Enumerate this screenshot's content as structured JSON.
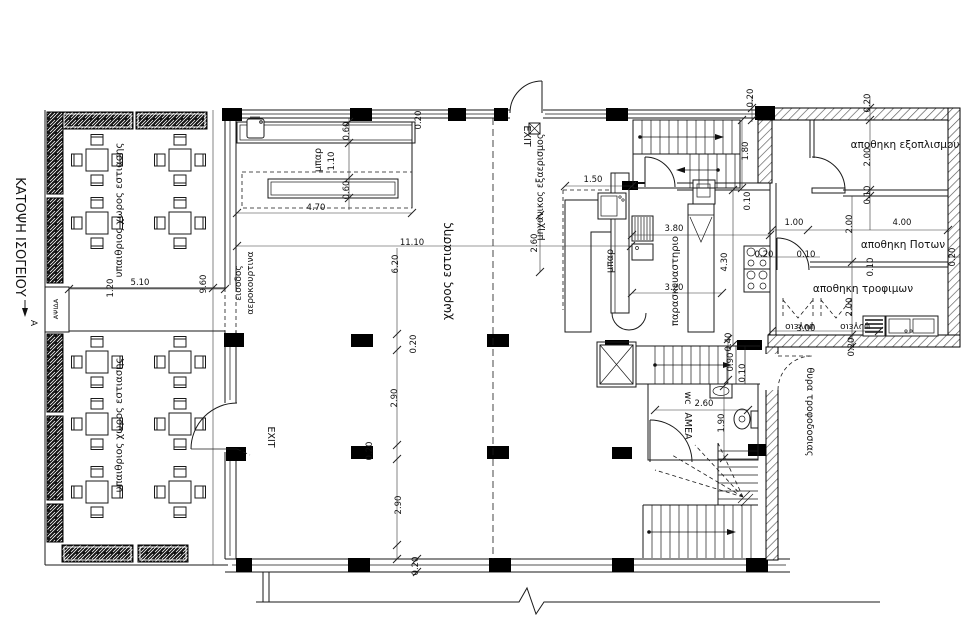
{
  "title": {
    "text": "ΚΑΤΟΨΗ ΙΣΟΓΕΙΟΥ"
  },
  "colors": {
    "line": "#1a1a1a",
    "background": "#ffffff"
  },
  "labels": [
    {
      "name": "plan-title",
      "text": "ΚΑΤΟΨΗ ΙΣΟΓΕΙΟΥ",
      "x": 16,
      "y": 237,
      "rot": 90,
      "size": 13
    },
    {
      "name": "section-marker-a",
      "text": "A",
      "x": 31,
      "y": 323,
      "rot": 90,
      "size": 9
    },
    {
      "name": "room-outdoor-dining-upper",
      "text": "υπαιθριος χωρος εστιασης",
      "x": 122,
      "y": 210,
      "rot": -90,
      "size": 10
    },
    {
      "name": "room-outdoor-dining-lower",
      "text": "υπαιθριος χωρος εστιασης",
      "x": 122,
      "y": 425,
      "rot": -90,
      "size": 10
    },
    {
      "name": "arch-label",
      "text": "ΑΨΙΔΑ",
      "x": 58,
      "y": 309,
      "rot": -90,
      "size": 6.5
    },
    {
      "name": "air-curtain-label",
      "text": "αεροκουρτινα",
      "x": 253,
      "y": 283,
      "rot": -90,
      "size": 9
    },
    {
      "name": "entrance-label",
      "text": "εισοδος",
      "x": 241,
      "y": 283,
      "rot": -90,
      "size": 9
    },
    {
      "name": "bar-label-top",
      "text": "μπαρ",
      "x": 321,
      "y": 160,
      "rot": -90,
      "size": 9.5
    },
    {
      "name": "room-dining-hall",
      "text": "χωρος εστιασης",
      "x": 451,
      "y": 271,
      "rot": -90,
      "size": 12
    },
    {
      "name": "exit-label-top",
      "text": "EXIT",
      "x": 524,
      "y": 136,
      "rot": 90,
      "size": 9.5
    },
    {
      "name": "mech-ventilation-label",
      "text": "μηχανικος εξαερισμος",
      "x": 543,
      "y": 187,
      "rot": -90,
      "size": 9.5
    },
    {
      "name": "bar-label-kitchen",
      "text": "μπαρ",
      "x": 613,
      "y": 261,
      "rot": -90,
      "size": 9.5
    },
    {
      "name": "room-kitchen",
      "text": "παρασκευαστηριο",
      "x": 678,
      "y": 281,
      "rot": -90,
      "size": 10
    },
    {
      "name": "room-storage-equipment",
      "text": "αποθηκη εξοπλισμου",
      "x": 905,
      "y": 148,
      "rot": 0,
      "size": 10.5
    },
    {
      "name": "room-storage-drinks",
      "text": "αποθηκη Ποτων",
      "x": 903,
      "y": 248,
      "rot": 0,
      "size": 10.5
    },
    {
      "name": "room-storage-food",
      "text": "αποθηκη τροφιμων",
      "x": 863,
      "y": 292,
      "rot": 0,
      "size": 10.5
    },
    {
      "name": "fridge-label-1",
      "text": "ψυγειο",
      "x": 800,
      "y": 324,
      "rot": 180,
      "size": 9
    },
    {
      "name": "fridge-label-2",
      "text": "ψυγειο",
      "x": 855,
      "y": 324,
      "rot": 180,
      "size": 9
    },
    {
      "name": "exit-label-left",
      "text": "EXIT",
      "x": 268,
      "y": 437,
      "rot": 90,
      "size": 9.5
    },
    {
      "name": "wc-label",
      "text": "wc",
      "x": 685,
      "y": 398,
      "rot": 90,
      "size": 9.5
    },
    {
      "name": "wc-amea-label",
      "text": "ΑΜΕΑ",
      "x": 685,
      "y": 426,
      "rot": 90,
      "size": 9.5
    },
    {
      "name": "supply-door-label",
      "text": "θυρα τροφοδοσιας",
      "x": 807,
      "y": 412,
      "rot": 90,
      "size": 9.5
    }
  ],
  "dimensions": [
    {
      "value": "0.20",
      "x": 421,
      "y": 120,
      "rot": -90
    },
    {
      "value": "0.60",
      "x": 349,
      "y": 131,
      "rot": -90
    },
    {
      "value": "1.10",
      "x": 334,
      "y": 161,
      "rot": -90
    },
    {
      "value": "0.60",
      "x": 349,
      "y": 190,
      "rot": -90
    },
    {
      "value": "4.70",
      "x": 316,
      "y": 210,
      "rot": 0
    },
    {
      "value": "11.10",
      "x": 412,
      "y": 245,
      "rot": 0
    },
    {
      "value": "6.20",
      "x": 398,
      "y": 264,
      "rot": -90
    },
    {
      "value": "0.20",
      "x": 416,
      "y": 344,
      "rot": -90
    },
    {
      "value": "2.90",
      "x": 397,
      "y": 398,
      "rot": -90
    },
    {
      "value": "0.20",
      "x": 372,
      "y": 451,
      "rot": -90
    },
    {
      "value": "2.90",
      "x": 401,
      "y": 505,
      "rot": -90
    },
    {
      "value": "0.20",
      "x": 418,
      "y": 566,
      "rot": -90
    },
    {
      "value": "1.20",
      "x": 113,
      "y": 288,
      "rot": -90
    },
    {
      "value": "5.10",
      "x": 140,
      "y": 285,
      "rot": 0
    },
    {
      "value": "9.60",
      "x": 206,
      "y": 284,
      "rot": -90
    },
    {
      "value": "0.20",
      "x": 753,
      "y": 98,
      "rot": -90
    },
    {
      "value": "1.80",
      "x": 748,
      "y": 151,
      "rot": -90
    },
    {
      "value": "1.50",
      "x": 593,
      "y": 182,
      "rot": 0
    },
    {
      "value": "2.60",
      "x": 537,
      "y": 243,
      "rot": -90
    },
    {
      "value": "3.80",
      "x": 674,
      "y": 231,
      "rot": 0
    },
    {
      "value": "4.30",
      "x": 727,
      "y": 262,
      "rot": -90
    },
    {
      "value": "3.20",
      "x": 674,
      "y": 290,
      "rot": 0
    },
    {
      "value": "0.10",
      "x": 750,
      "y": 201,
      "rot": -90
    },
    {
      "value": "0.20",
      "x": 764,
      "y": 257,
      "rot": 0
    },
    {
      "value": "0.10",
      "x": 806,
      "y": 257,
      "rot": 0
    },
    {
      "value": "1.00",
      "x": 794,
      "y": 225,
      "rot": 0
    },
    {
      "value": "4.00",
      "x": 902,
      "y": 225,
      "rot": 0
    },
    {
      "value": "2.00",
      "x": 852,
      "y": 224,
      "rot": -90
    },
    {
      "value": "0.20",
      "x": 870,
      "y": 103,
      "rot": -90
    },
    {
      "value": "2.00",
      "x": 870,
      "y": 157,
      "rot": -90
    },
    {
      "value": "0.10",
      "x": 870,
      "y": 195,
      "rot": -90
    },
    {
      "value": "0.10",
      "x": 873,
      "y": 267,
      "rot": -90
    },
    {
      "value": "2.00",
      "x": 852,
      "y": 307,
      "rot": -90
    },
    {
      "value": "3.00",
      "x": 806,
      "y": 331,
      "rot": 0
    },
    {
      "value": "0.20",
      "x": 854,
      "y": 347,
      "rot": -90
    },
    {
      "value": "0.20",
      "x": 955,
      "y": 257,
      "rot": -90
    },
    {
      "value": "0.40",
      "x": 731,
      "y": 342,
      "rot": -90
    },
    {
      "value": "0.90",
      "x": 733,
      "y": 362,
      "rot": -90
    },
    {
      "value": "0.10",
      "x": 745,
      "y": 373,
      "rot": -90
    },
    {
      "value": "2.60",
      "x": 704,
      "y": 406,
      "rot": 0
    },
    {
      "value": "1.90",
      "x": 724,
      "y": 423,
      "rot": -90
    }
  ]
}
